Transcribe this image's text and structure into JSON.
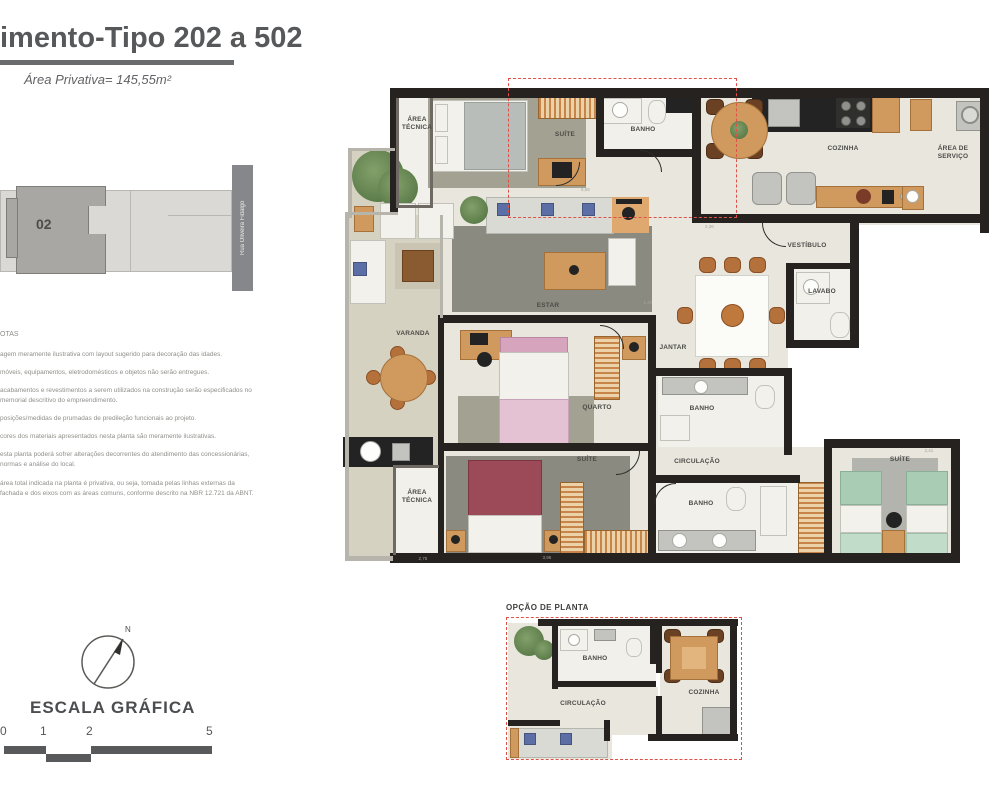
{
  "header": {
    "title": "imento-Tipo 202 a 502",
    "subtitle": "Área Privativa= 145,55m²"
  },
  "key_plan": {
    "unit": "02",
    "street": "Rua Oliveira Fidalgo"
  },
  "notes": {
    "heading": "OTAS",
    "paragraphs": [
      "agem meramente ilustrativa com layout sugerido para decoração das idades.",
      "móveis, equipamentos, eletrodomésticos e objetos não serão entregues.",
      "acabamentos e revestimentos a serem utilizados na construção serão especificados no memorial descritivo do empreendimento.",
      "posições/medidas de prumadas de predileção funcionais ao projeto.",
      "cores dos materiais apresentados nesta planta são meramente ilustrativas.",
      "esta planta poderá sofrer alterações decorrentes do atendimento das concessionárias, normas e análise do local.",
      "área total indicada na planta é privativa, ou seja, tomada pelas linhas externas da fachada e dos eixos com as áreas comuns, conforme descrito na NBR 12.721 da ABNT."
    ]
  },
  "compass": {
    "north": "N"
  },
  "scale_bar": {
    "title": "ESCALA GRÁFICA",
    "ticks": [
      "0",
      "1",
      "2",
      "5"
    ]
  },
  "main_plan": {
    "rooms": {
      "area_tecnica_top": "ÁREA TÉCNICA",
      "suite1": "SUÍTE",
      "banho1": "BANHO",
      "cozinha": "COZINHA",
      "area_servico": "ÁREA DE SERVIÇO",
      "vestibulo": "VESTÍBULO",
      "lavabo": "LAVABO",
      "estar": "ESTAR",
      "varanda": "VARANDA",
      "jantar": "JANTAR",
      "quarto": "QUARTO",
      "banho2": "BANHO",
      "suite2": "SUÍTE",
      "area_tecnica_bottom": "ÁREA TÉCNICA",
      "circulacao": "CIRCULAÇÃO",
      "banho3": "BANHO",
      "suite3": "SUÍTE"
    },
    "dimensions": [
      "5,06",
      "2,36",
      "1,40",
      "2,41",
      "3,95",
      "2,75"
    ]
  },
  "option_plan": {
    "title": "OPÇÃO DE PLANTA",
    "rooms": {
      "banho": "BANHO",
      "circulacao": "CIRCULAÇÃO",
      "cozinha": "COZINHA"
    }
  },
  "colors": {
    "wall": "#26221f",
    "dashed_accent": "#de5148",
    "wood": "#d09a5e",
    "floor": "#e9e6de"
  }
}
